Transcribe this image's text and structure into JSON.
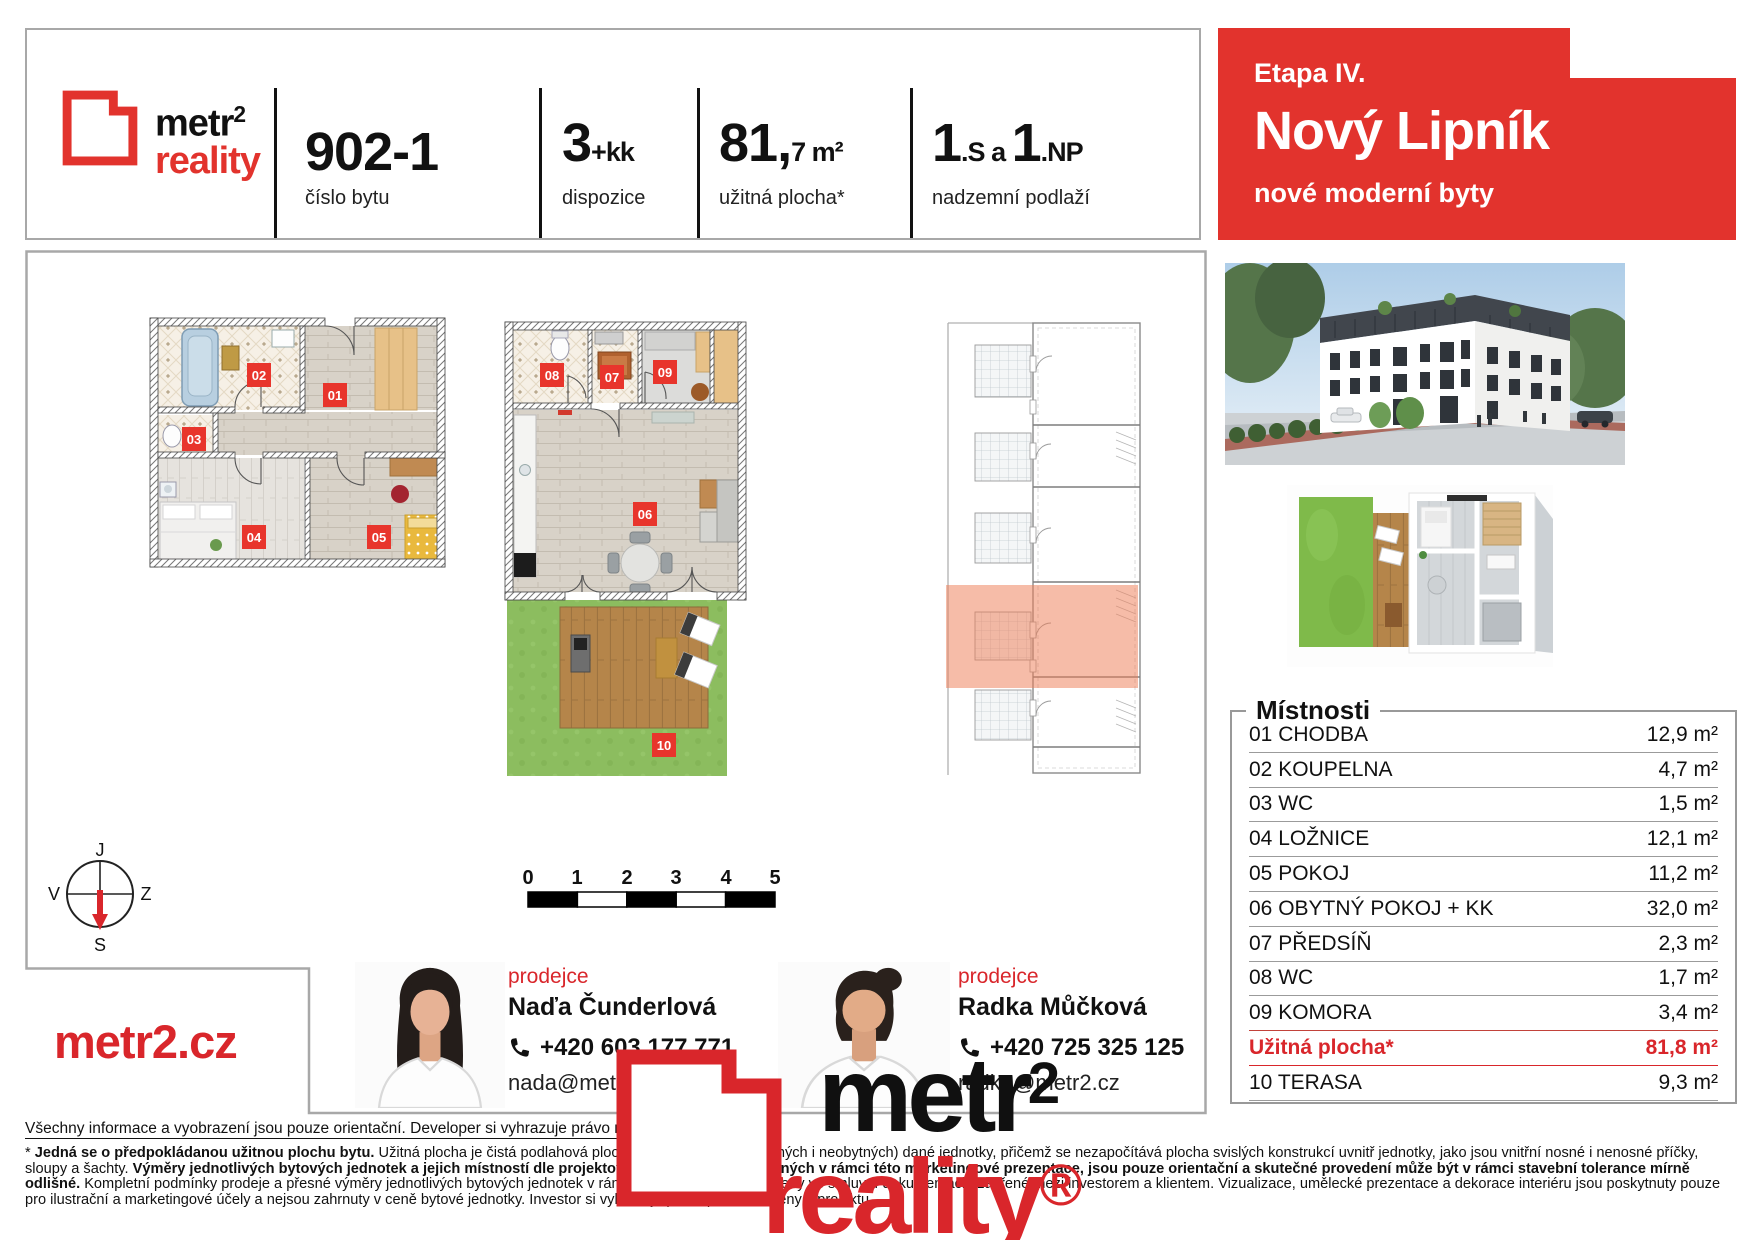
{
  "brand": {
    "name_black": "metr",
    "sup": "2",
    "name_red": "reality",
    "reg": "®",
    "website": "metr2.cz"
  },
  "header": {
    "unit_number": "902-1",
    "unit_number_label": "číslo bytu",
    "layout_value": "3",
    "layout_suffix": "+kk",
    "layout_label": "dispozice",
    "area_value": "81,",
    "area_suffix": "7 m²",
    "area_label": "užitná plocha*",
    "floors_v1": "1",
    "floors_s1": ".S",
    "floors_mid": " a ",
    "floors_v2": "1",
    "floors_s2": ".NP",
    "floors_label": "nadzemní podlaží"
  },
  "banner": {
    "phase": "Etapa IV.",
    "project": "Nový Lipník",
    "tagline": "nové moderní byty"
  },
  "compass": {
    "top": "J",
    "right": "Z",
    "bottom": "S",
    "left": "V"
  },
  "scalebar": {
    "ticks": [
      "0",
      "1",
      "2",
      "3",
      "4",
      "5"
    ]
  },
  "plan_labels": {
    "l01": "01",
    "l02": "02",
    "l03": "03",
    "l04": "04",
    "l05": "05",
    "l06": "06",
    "l07": "07",
    "l08": "08",
    "l09": "09",
    "l10": "10"
  },
  "rooms": {
    "title": "Místnosti",
    "rows": [
      {
        "name": "01 CHODBA",
        "area": "12,9 m²"
      },
      {
        "name": "02 KOUPELNA",
        "area": "4,7 m²"
      },
      {
        "name": "03 WC",
        "area": "1,5 m²"
      },
      {
        "name": "04 LOŽNICE",
        "area": "12,1 m²"
      },
      {
        "name": "05 POKOJ",
        "area": "11,2 m²"
      },
      {
        "name": "06 OBYTNÝ POKOJ + KK",
        "area": "32,0 m²"
      },
      {
        "name": "07 PŘEDSÍŇ",
        "area": "2,3 m²"
      },
      {
        "name": "08 WC",
        "area": "1,7 m²"
      },
      {
        "name": "09 KOMORA",
        "area": "3,4 m²"
      },
      {
        "name": "Užitná plocha*",
        "area": "81,8 m²",
        "highlight": true
      },
      {
        "name": "10 TERASA",
        "area": "9,3 m²"
      }
    ]
  },
  "agents": [
    {
      "role": "prodejce",
      "name": "Naďa Čunderlová",
      "phone": "+420 603 177 771",
      "email": "nada@metr2.cz"
    },
    {
      "role": "prodejce",
      "name": "Radka Můčková",
      "phone": "+420 725 325 125",
      "email": "radka@metr2.cz"
    }
  ],
  "footer": {
    "note": "Všechny informace a vyobrazení jsou pouze orientační. Developer si vyhrazuje právo na změny.",
    "disclaimer": [
      {
        "t": "* "
      },
      {
        "t": "Jedná se o předpokládanou užitnou plochu bytu."
      },
      {
        "t": " Užitná plocha je čistá podlahová plocha všech místností (obytných i neobytných) dané jednotky, přičemž se nezapočítává plocha svislých konstrukcí uvnitř jednotky, jako jsou vnitřní nosné i nenosné příčky, sloupy a šachty. "
      },
      {
        "t": "Výměry jednotlivých bytových jednotek a jejich místností dle projektové dokumentace, uvedených v rámci této marketingové prezentace, jsou pouze orientační a skutečné provedení může být v rámci stavební tolerance mírně odlišné."
      },
      {
        "t": " Kompletní podmínky prodeje a přesné výměry jednotlivých bytových jednotek v rámci projektu budou zakotveny ve smluvní dokumentaci uzavřené mezi investorem a klientem. Vizualizace, umělecké prezentace a dekorace interiéru jsou poskytnuty pouze pro ilustrační a marketingové účely a nejsou zahrnuty v ceně bytové jednotky. Investor si vyhrazuje právo provést změny v projektu."
      }
    ]
  },
  "colors": {
    "brand_red": "#e2332d",
    "highlight_salmon": "#ee7f58",
    "border_gray": "#a8a8a8"
  }
}
